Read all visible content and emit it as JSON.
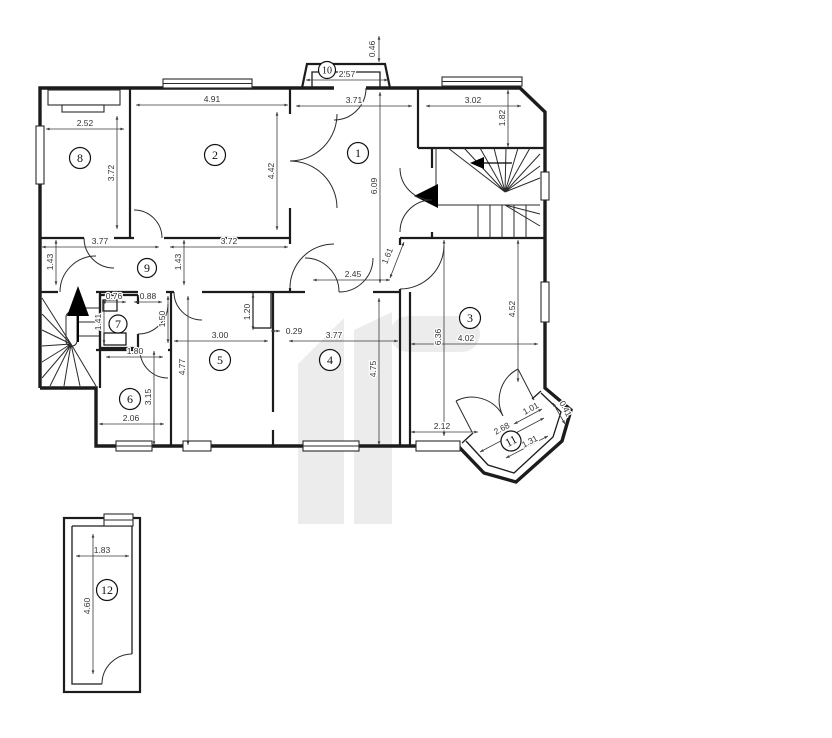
{
  "meta": {
    "drawing_type": "architectural floor plan",
    "units": "m"
  },
  "palette": {
    "wall": "#1c1c1c",
    "dim_text": "#333333",
    "watermark": "#ececec",
    "background": "#ffffff"
  },
  "rooms": [
    "1",
    "2",
    "3",
    "4",
    "5",
    "6",
    "7",
    "8",
    "9",
    "10",
    "11",
    "12"
  ],
  "dims": {
    "room8_width": "2.52",
    "room8_height": "3.72",
    "room2_width": "4.91",
    "room2_height": "4.42",
    "balcony10_width": "2.57",
    "balcony10_depth": "0.46",
    "room1_width": "3.71",
    "room1_height": "6.09",
    "landing_width": "3.02",
    "landing_height": "1.82",
    "corridor_left_width": "3.77",
    "corridor_right_width": "3.72",
    "corridor_left_height": "1.43",
    "corridor_right_height": "1.43",
    "room7_width": "0.76",
    "room7_door": "0.88",
    "room7_height_left": "1.41",
    "room7_height_right": "1.50",
    "room6_top_width": "1.80",
    "room6_height": "3.15",
    "room6_bottom_width": "2.06",
    "room5_width": "3.00",
    "room5_height": "4.77",
    "room5_nook_depth": "1.20",
    "room5_nook_offset": "0.29",
    "room4_width": "3.77",
    "room4_height": "4.75",
    "hall_width": "2.45",
    "hall_diag": "1.61",
    "room3_width": "4.02",
    "room3_height_right": "4.52",
    "room3_height_left": "6.36",
    "room3_bottom_width": "2.12",
    "balcony11_length": "2.68",
    "balcony11_side": "1.01",
    "balcony11_bottom": "1.31",
    "balcony11_end": "0.41",
    "room12_width": "1.83",
    "room12_height": "4.60"
  }
}
